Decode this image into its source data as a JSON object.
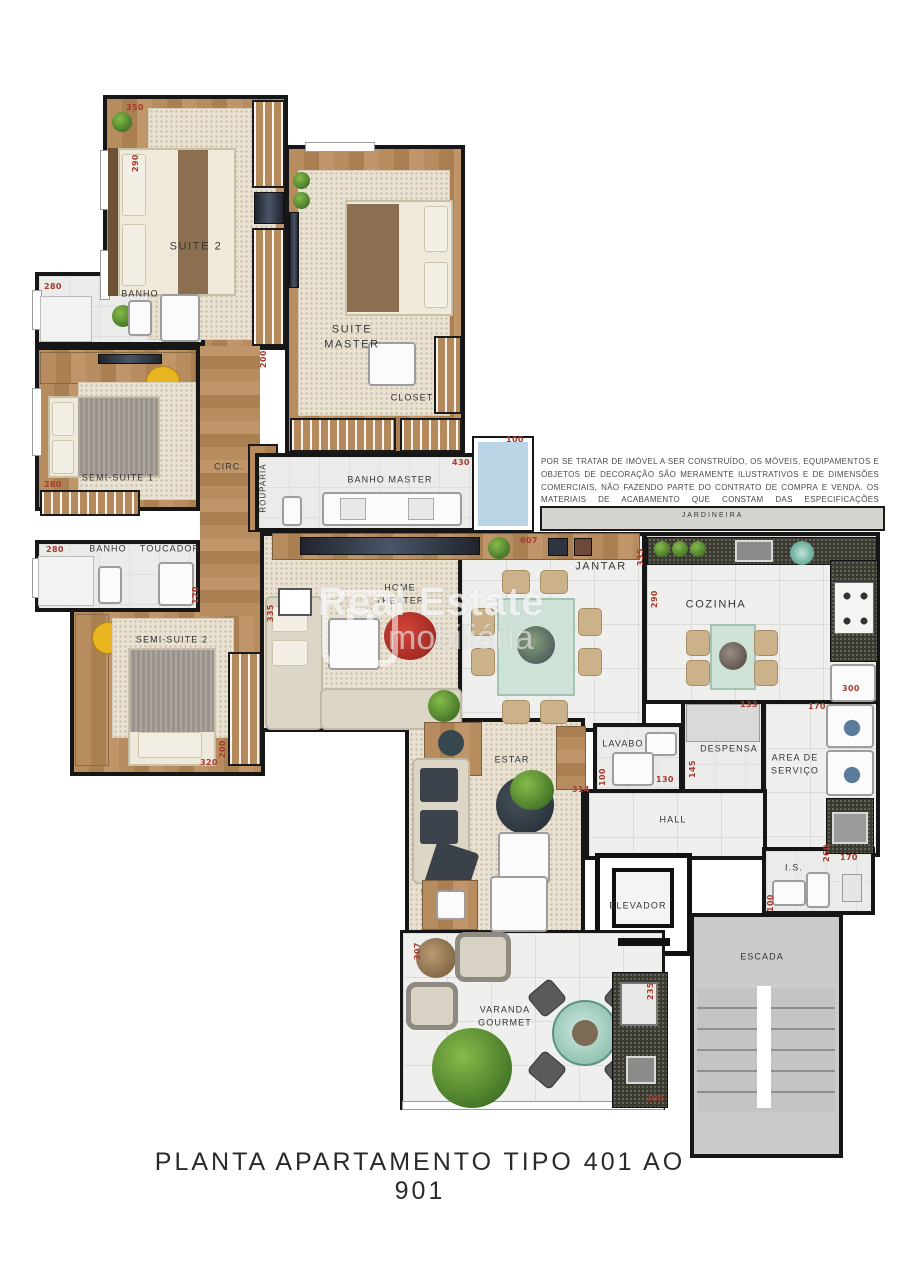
{
  "title": "PLANTA APARTAMENTO TIPO 401 AO 901",
  "watermark": {
    "logo": "R",
    "line1": "Real Estate",
    "line2": "mobiliária"
  },
  "disclaimer": "POR SE TRATAR DE IMÓVEL A SER CONSTRUÍDO, OS MÓVEIS, EQUIPAMENTOS E OBJETOS DE DECORAÇÃO SÃO MERAMENTE ILUSTRATIVOS E DE DIMENSÕES COMERCIAIS, NÃO FAZENDO PARTE DO CONTRATO DE COMPRA E VENDA. OS MATERIAIS DE ACABAMENTO QUE CONSTAM DAS ESPECIFICAÇÕES CONTRATUAIS PREVALECEM SOBRE ESTAS ILUSTRAÇÕES.",
  "strip_label": "JARDINEIRA",
  "rooms": {
    "suite2": "SUITE 2",
    "suite_master": "SUITE\nMASTER",
    "closet": "CLOSET",
    "banho1": "BANHO",
    "semi_suite1": "SEMI-SUITE 1",
    "circ": "CIRC.",
    "rouparia": "ROUPARIA",
    "banho2": "BANHO",
    "toucador": "TOUCADOR",
    "semi_suite2": "SEMI-SUITE 2",
    "banho_master": "BANHO MASTER",
    "home_theater": "HOME\nTHEATER",
    "jantar": "JANTAR",
    "cozinha": "COZINHA",
    "lavabo": "LAVABO",
    "despensa": "DESPENSA",
    "area_servico": "AREA DE\nSERVIÇO",
    "hall": "HALL",
    "estar": "ESTAR",
    "elevador": "ELEVADOR",
    "is": "I.S.",
    "escada": "ESCADA",
    "varanda": "VARANDA\nGOURMET"
  },
  "dims": [
    {
      "t": "350"
    },
    {
      "t": "290"
    },
    {
      "t": "280"
    },
    {
      "t": "280"
    },
    {
      "t": "280"
    },
    {
      "t": "120"
    },
    {
      "t": "200"
    },
    {
      "t": "320"
    },
    {
      "t": "200"
    },
    {
      "t": "100"
    },
    {
      "t": "430"
    },
    {
      "t": "335"
    },
    {
      "t": "607"
    },
    {
      "t": "335"
    },
    {
      "t": "290"
    },
    {
      "t": "300"
    },
    {
      "t": "133"
    },
    {
      "t": "145"
    },
    {
      "t": "130"
    },
    {
      "t": "100"
    },
    {
      "t": "170"
    },
    {
      "t": "260"
    },
    {
      "t": "314"
    },
    {
      "t": "170"
    },
    {
      "t": "100"
    },
    {
      "t": "235"
    },
    {
      "t": "300"
    },
    {
      "t": "307"
    }
  ]
}
